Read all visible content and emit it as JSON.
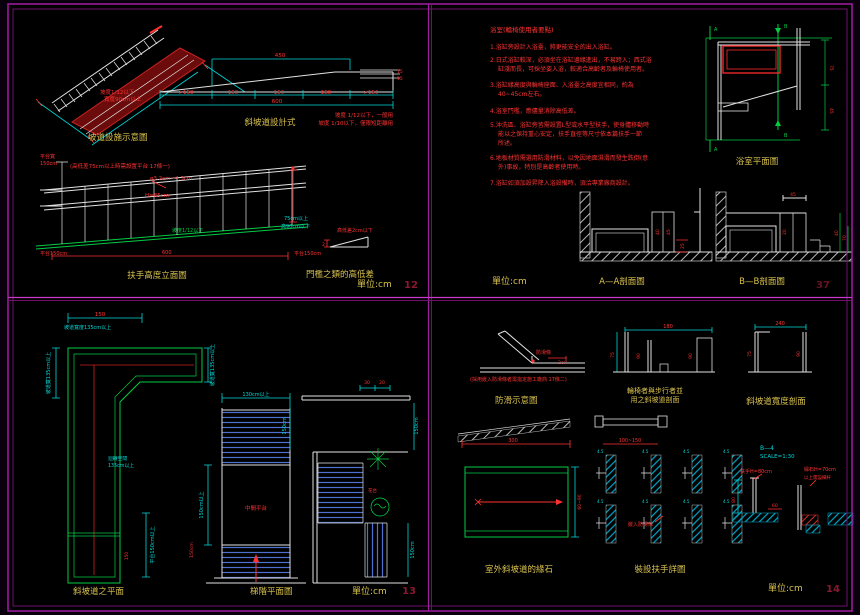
{
  "q1": {
    "iso": {
      "title": "坡道設施示意圖",
      "note1": "坡度1/12以下",
      "note2": "寬度90cm以上"
    },
    "section": {
      "title": "斜坡道設計式",
      "dim_top": "450",
      "seg1": ">150",
      "seg2": "150",
      "seg3": "150",
      "seg4": "150",
      "seg5": ">150",
      "dim_total": "600",
      "side1": "15",
      "side2": "15",
      "note1": "坡度 1/12以下，一般用",
      "note2": "坡度 1/10以下，僅限短距離用"
    },
    "handrail": {
      "title": "扶手高度立面圖",
      "note": "(高低差75cm以上時需設置平台 17條一)",
      "dia": "ø3.2cm~4.3cm",
      "height": "H=85cm",
      "slope": "坡度1/12以下",
      "length": "600",
      "right1": "75cm以上",
      "right2": "高90cm以下",
      "left1": "平台寬",
      "left2": "150cm",
      "platform_l": "平台150cm",
      "platform_r": "平台150cm"
    },
    "threshold": {
      "title": "門檻之類的高低差",
      "note": "高低差2cm以下",
      "dim": "2"
    },
    "unit": "單位:cm",
    "page": "12"
  },
  "q2": {
    "title": "浴室(輪椅使用者要點)",
    "notes": [
      "1.浴缸旁設計入浴臺，將更能安全的出入浴缸。",
      "2.日式浴缸較深，必須坐在浴缸邊緣進出，不易跨入；西式浴",
      "缸淺而長，可採坐姿入浴，較適合高齡者及輪椅使用者。",
      "3.浴缸緣高度與輪椅座面、入浴臺之高度宜相同，約為",
      "40~45cm左右。",
      "4.浴室門檻，應儘量消除高低差。",
      "5.沖洗區、浴缸旁皆需設置L型或水平型扶手，使身體移動時",
      "能以之保持重心安定，扶手直徑等尺寸依本篇扶手一節",
      "所述。",
      "6.地板材質需選用防滑材料，以免因地面濕滑而發生跌倒(意",
      "外)事故，特別是高齡者使用時。",
      "7.浴缸如須加設昇降入浴設備時，須洽專業廠商設計。"
    ],
    "plan": {
      "title": "浴室平面圖",
      "a": "A",
      "b": "B",
      "d1": "75",
      "d2": "45"
    },
    "sa": {
      "title": "A—A剖面圖",
      "d1": "40",
      "d2": "45",
      "d3": "25"
    },
    "sb": {
      "title": "B—B剖面圖",
      "d1": "45",
      "d2": "20",
      "d3": "40",
      "d4": "70"
    },
    "unit": "單位:cm",
    "page": "37"
  },
  "q3": {
    "lramp": {
      "title": "斜坡道之平面",
      "dim_top": "150",
      "w_top": "坡道寬度135cm以上",
      "w_left": "坡道寬135cm以上",
      "w_right": "坡道寬135cm以上",
      "turn1": "迴轉空間",
      "turn2": "135cm以上",
      "platform": "平台150cm以上",
      "dim_b": "150"
    },
    "stair": {
      "title": "梯階平面圖",
      "dim_top": "130cm以上",
      "dim_left": "150cm以上",
      "dim_left2": "150cm",
      "landing": "中間平台"
    },
    "rplan": {
      "d1": "30",
      "d2": "20",
      "r1": "150cm",
      "r2": "150cm",
      "l1": "150cm",
      "plant": "花台"
    },
    "unit": "單位:cm",
    "page": "13"
  },
  "q4": {
    "antislip": {
      "title": "防滑示意圖",
      "label": "防滑條",
      "dim": "2cm",
      "note": "(採用嵌入防滑條者需指定施工廠商 17條二)"
    },
    "s1": {
      "line1": "輪椅者與步行者並",
      "line2": "用之斜坡道剖面",
      "top": "180",
      "d1": "75",
      "d2": "90",
      "d3": "90"
    },
    "s2": {
      "title": "斜坡道寬度剖面",
      "top": "240",
      "d1": "75",
      "d2": "90"
    },
    "side": {
      "d1": "300",
      "d2": "100~150"
    },
    "curb": {
      "title": "室外斜坡道的緣石",
      "dim": "60~90"
    },
    "details": {
      "title": "裝設扶手詳圖",
      "label": "嵌入防滑條",
      "c": "4.5"
    },
    "b4": {
      "code": "B—4",
      "scale": "SCALE=1:30",
      "l1": "扶手H=80cm",
      "l2": "緣石H=70cm",
      "l3": "以上需設欄杆",
      "d1": "60",
      "d2": "80"
    },
    "unit": "單位:cm",
    "page": "14"
  }
}
